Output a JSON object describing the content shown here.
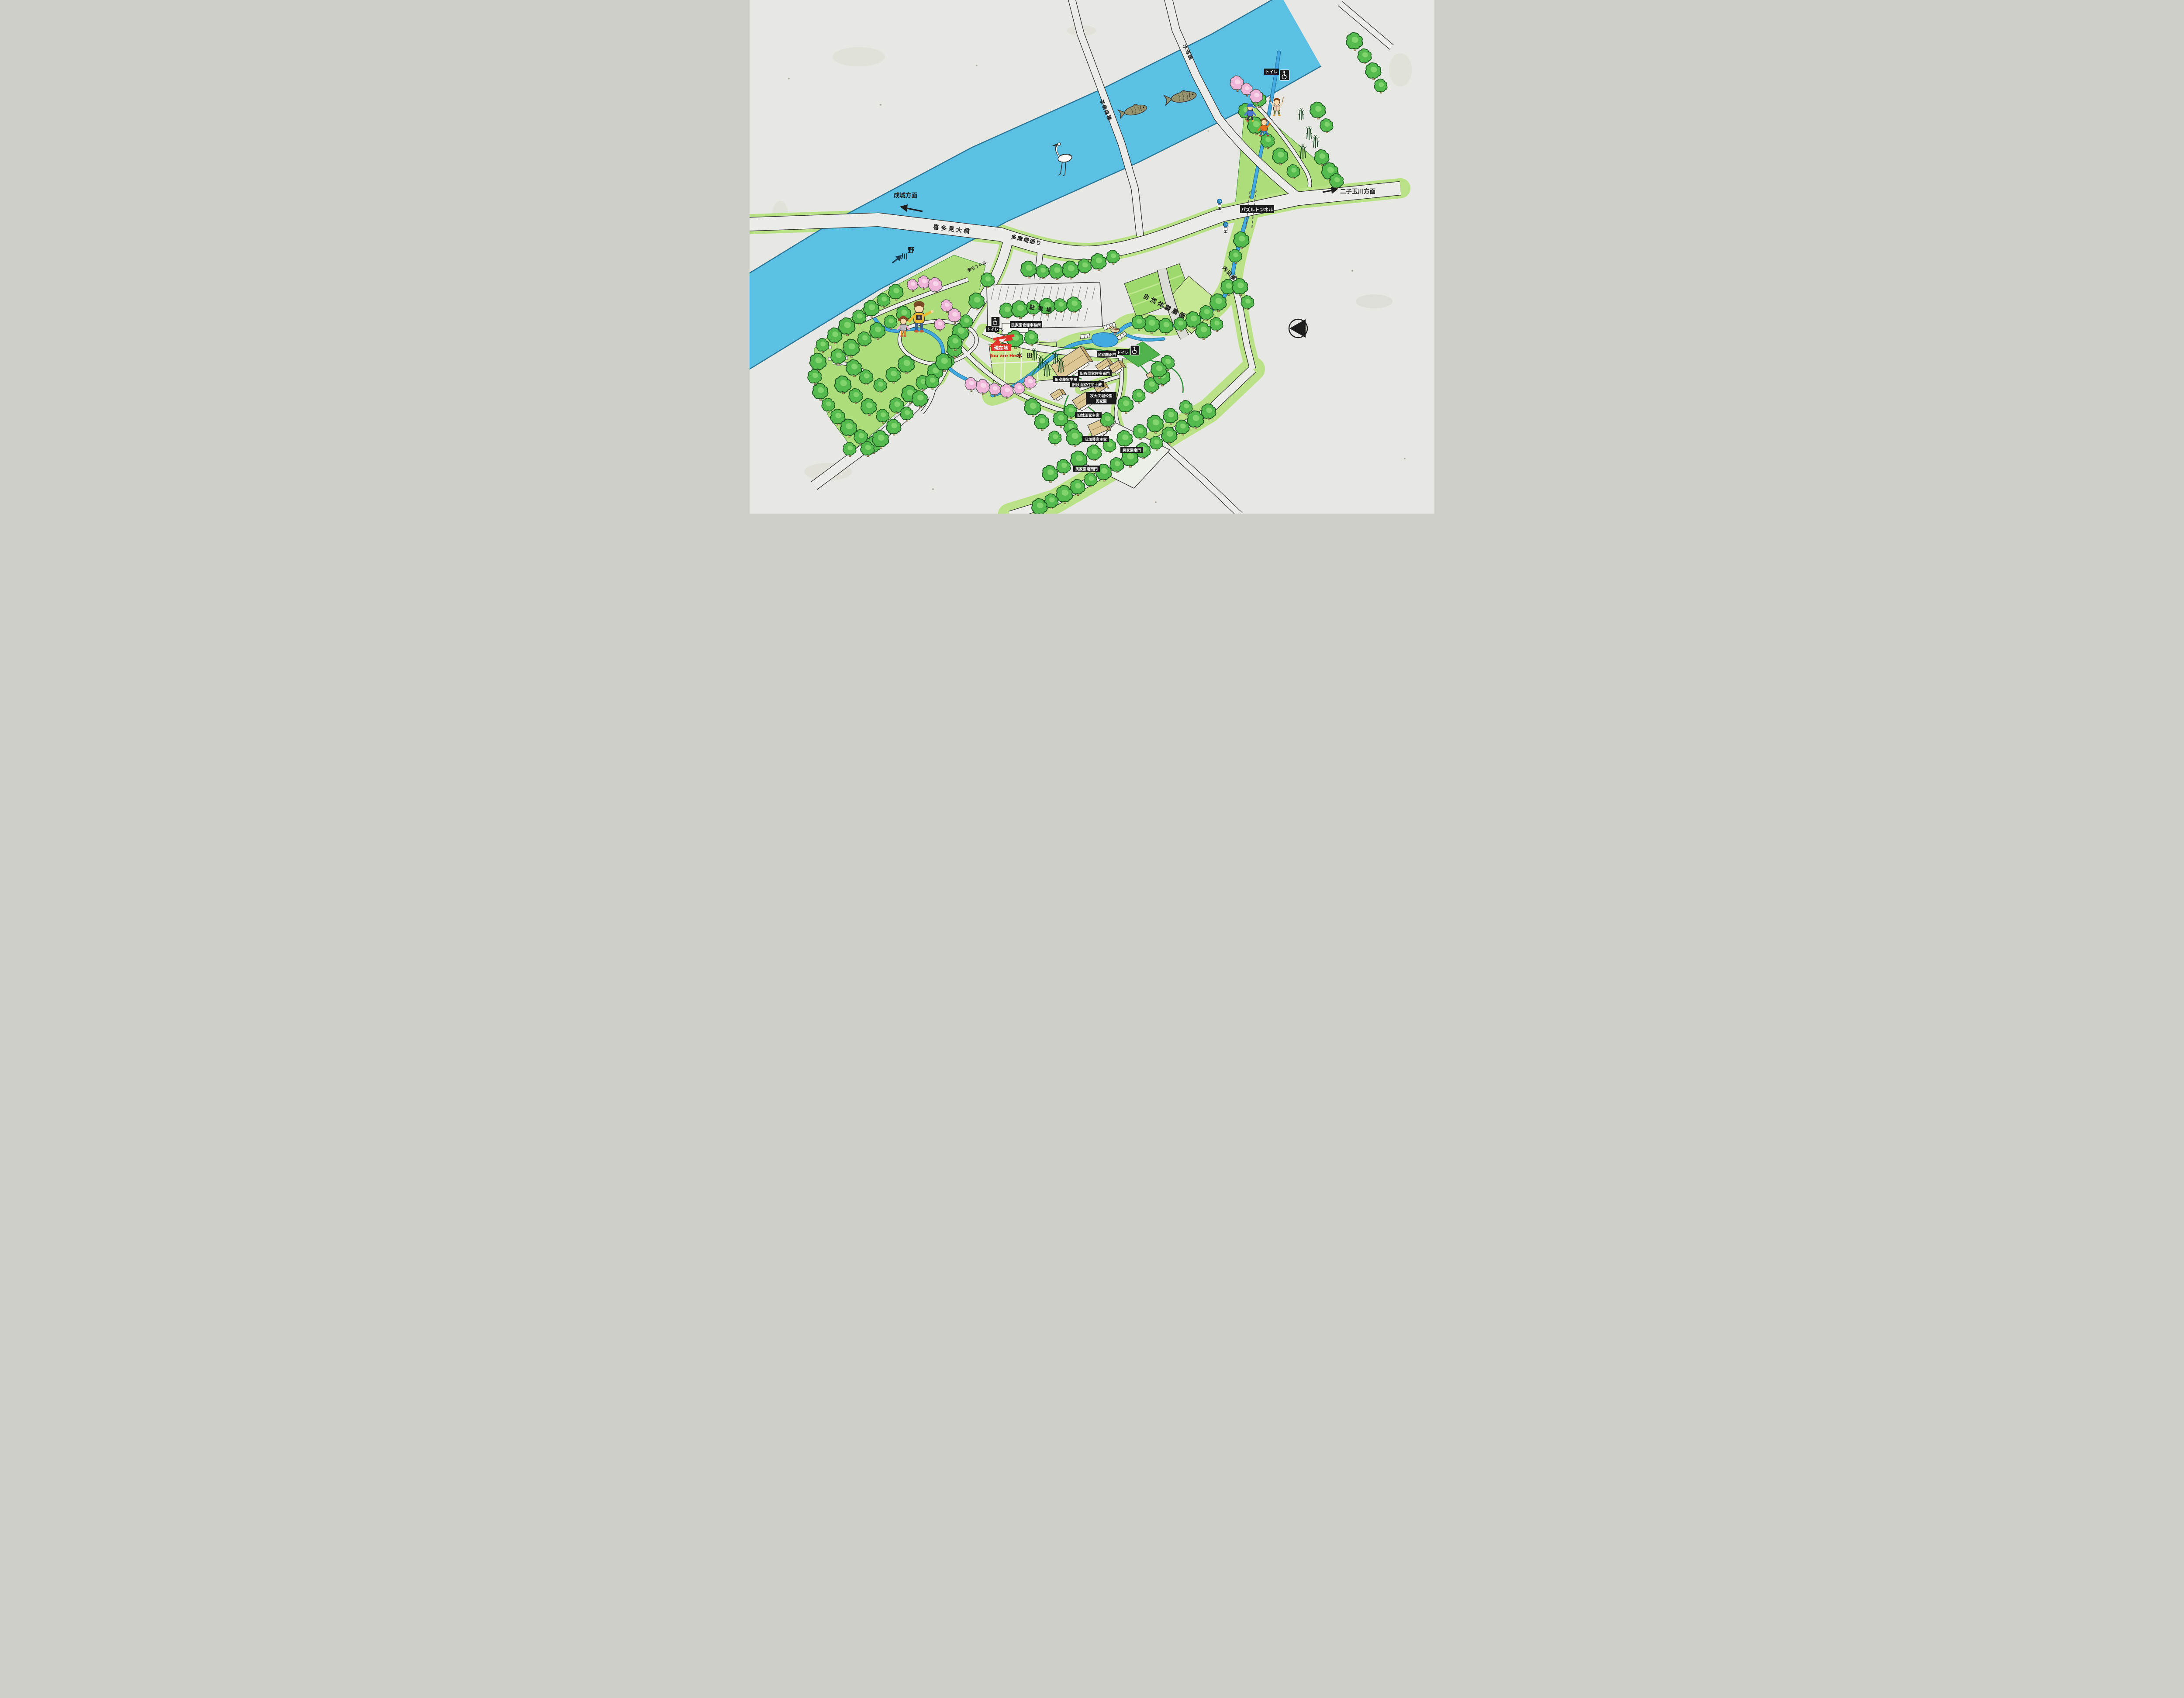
{
  "sign": {
    "marker": {
      "jp": "現在地",
      "en": "You are Here"
    },
    "river": {
      "name_chars": [
        "野",
        "川"
      ]
    },
    "bridges": {
      "suido": "水道橋",
      "chayado": "茶屋道橋",
      "kitami": "喜多見大橋",
      "uchida": "内田橋"
    },
    "roads": {
      "tamazutsumi": "多摩堤通り",
      "slope": "せっくら坂"
    },
    "directions": {
      "seijo": "成城方面",
      "futako": "二子玉川方面"
    },
    "landmarks": {
      "tunnel": "パズルトンネル",
      "farm": "自然体験農園",
      "paddy": "水田",
      "parking": "駐車場",
      "office": "民家園管理事務所"
    },
    "gates": {
      "main": "民家園正門",
      "south": "民家園南門",
      "southwest": "民家園南西門"
    },
    "houses": {
      "ando": "旧安藤家主屋",
      "tanioka": "旧谷岡家住宅表門",
      "akiyama": "旧秋山家住宅土蔵",
      "shirota": "旧城田家主家",
      "kato": "旧加藤家主家"
    },
    "park_name": {
      "line1": "次大夫堀公園",
      "line2": "民家園"
    },
    "toilet": "トイレ",
    "bus": "バス",
    "gate_mark": "✕",
    "colors": {
      "river": "#5cc0e4",
      "park_green": "#aede7c",
      "band_green": "#b9e286",
      "field_green": "#c7e795",
      "road": "#ecece8",
      "label_bg": "#1b1b1b",
      "marker_red": "#e0342b",
      "tree_green": "#55bb4e"
    }
  }
}
